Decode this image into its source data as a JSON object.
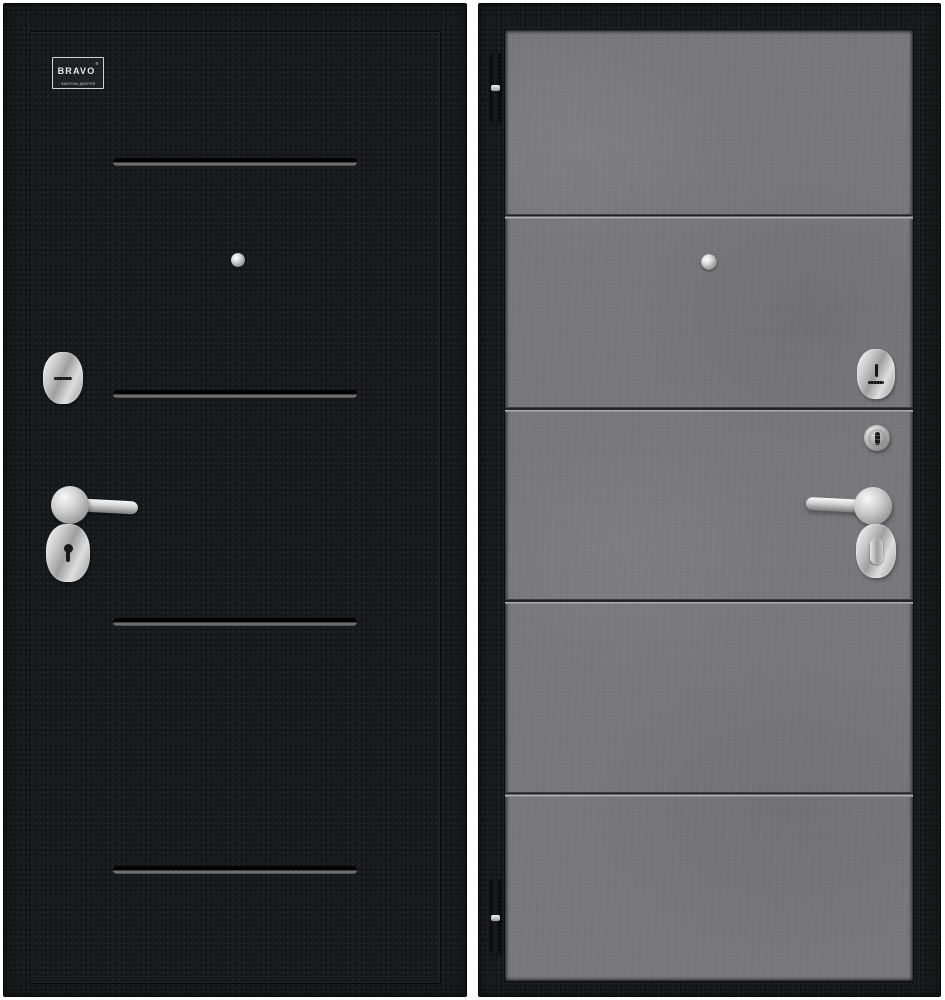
{
  "brand": {
    "logo_text": "BRAVO",
    "logo_mark": "®",
    "logo_tagline": "ФАБРИКА ДВЕРЕЙ"
  },
  "colors": {
    "background": "#ffffff",
    "door_exterior_black": "#17191b",
    "door_interior_concrete": "#7b7b7d",
    "door_interior_frame": "#121416",
    "hardware_chrome_light": "#efefef",
    "hardware_chrome_dark": "#8a8a8a",
    "groove_highlight": "#6f6f6f"
  },
  "exterior_door": {
    "decor_groove_count": 4,
    "hardware_icons": [
      "peephole-icon",
      "cylinder-escutcheon-icon",
      "lever-handle-icon",
      "keyhole-escutcheon-icon"
    ]
  },
  "interior_door": {
    "decor_groove_count": 4,
    "hardware_icons": [
      "hinge-icon",
      "peephole-icon",
      "night-latch-escutcheon-icon",
      "thumbturn-knob-icon",
      "lever-handle-icon",
      "thumbturn-escutcheon-icon",
      "hinge-icon"
    ]
  }
}
